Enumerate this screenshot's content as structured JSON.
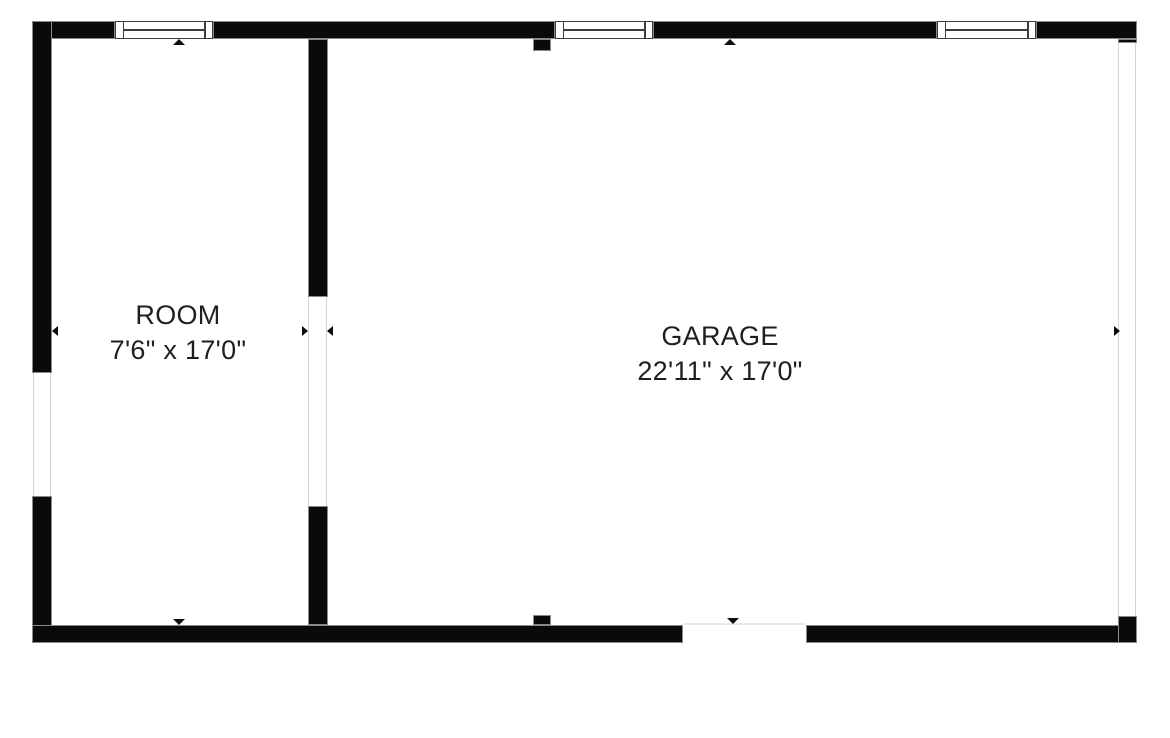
{
  "plan": {
    "background_color": "#ffffff",
    "wall_color": "#0a0a0a",
    "window_frame_color": "#3c3c3c",
    "opening_line_color": "#d5d5d5",
    "garage_door_line_color": "#e9e9e9",
    "text_color": "#1f1f1f"
  },
  "rooms": [
    {
      "name": "ROOM",
      "dimensions": "7'6\" x 17'0\""
    },
    {
      "name": "GARAGE",
      "dimensions": "22'11\" x 17'0\""
    }
  ],
  "features": {
    "window_count": 3,
    "markers": {
      "room_top_marker": "triangle-up",
      "garage_top_marker": "triangle-up",
      "room_bottom_marker": "triangle-down",
      "garage_door_marker": "triangle-down",
      "left_wall_marker": "triangle-left",
      "inner_wall_marker_left_side": "triangle-right",
      "inner_wall_marker_right_side": "triangle-left",
      "right_wall_marker": "triangle-right"
    }
  }
}
